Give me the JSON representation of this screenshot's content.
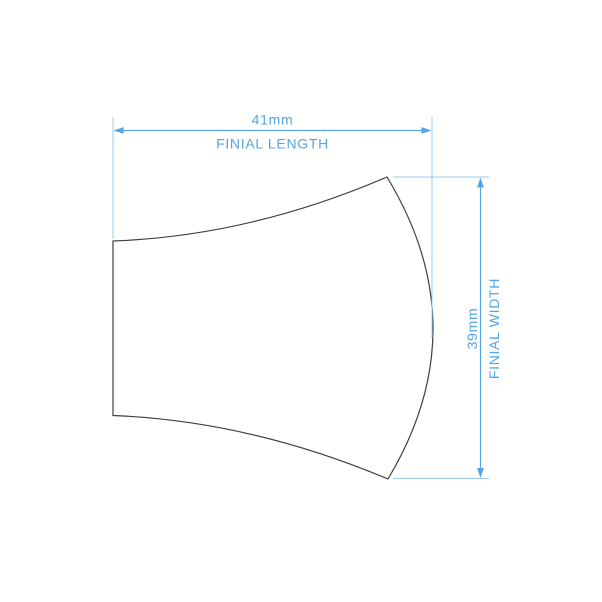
{
  "diagram": {
    "subject": "finial profile drawing",
    "dimensions": {
      "length": {
        "value": "41mm",
        "label": "FINIAL LENGTH"
      },
      "width": {
        "value": "39mm",
        "label": "FINIAL WIDTH"
      }
    }
  },
  "colors": {
    "accent": "#54a4e2",
    "extension": "#9ecbf0",
    "outline": "#3f3f3f",
    "background": "#ffffff"
  }
}
